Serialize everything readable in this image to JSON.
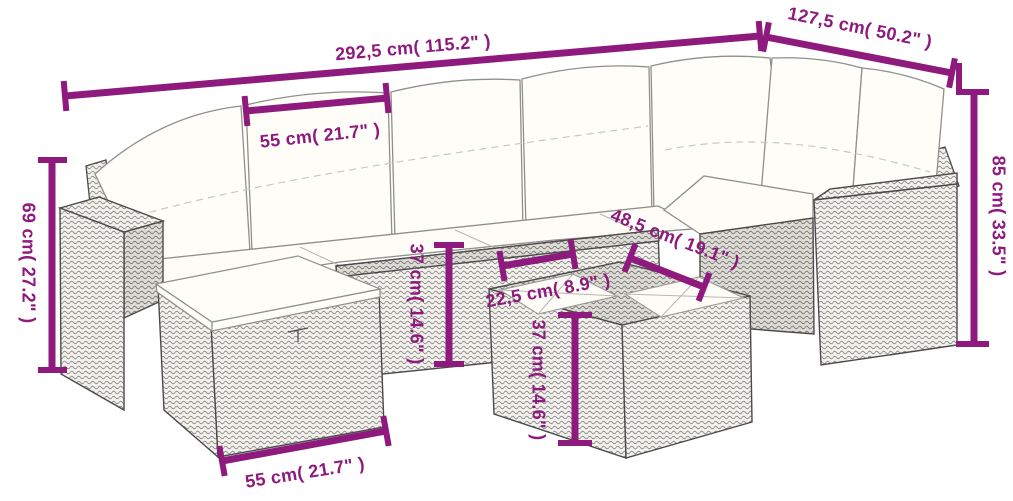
{
  "style": {
    "dimension_color": "#8E1A7D",
    "line_art_color": "#4A4A4A",
    "cushion_color": "#FEFDF8",
    "background": "#FFFFFF"
  },
  "scene": {
    "name": "rattan-garden-sofa-set-dimension-diagram",
    "pieces": [
      "corner-sofa-with-cushions",
      "footstool-with-cushion",
      "glass-top-wicker-table"
    ]
  },
  "dims": {
    "total_width": {
      "label": "292,5 cm( 115.2\" )"
    },
    "wing_depth": {
      "label": "127,5 cm( 50.2\" )"
    },
    "seat_width": {
      "label": "55 cm( 21.7\" )"
    },
    "arm_height": {
      "label": "69 cm( 27.2\" )"
    },
    "total_height": {
      "label": "85 cm( 33.5\" )"
    },
    "seat_height": {
      "label": "37 cm( 14.6\" )"
    },
    "table_length": {
      "label": "48,5 cm( 19.1\" )"
    },
    "table_width": {
      "label": "22,5 cm( 8.9\" )"
    },
    "table_height": {
      "label": "37 cm( 14.6\" )"
    },
    "stool_width": {
      "label": "55 cm( 21.7\" )"
    }
  }
}
